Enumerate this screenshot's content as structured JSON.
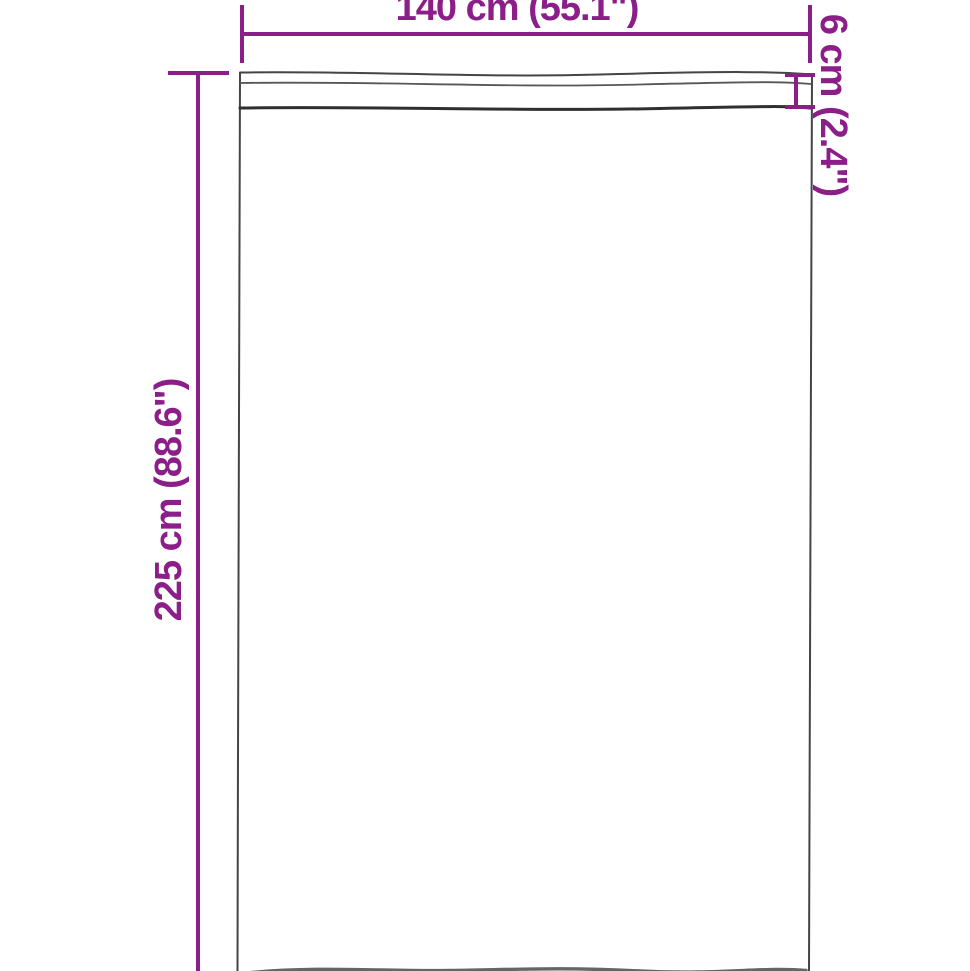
{
  "colors": {
    "accent": "#8b1e88",
    "outline": "#454545"
  },
  "diagram": {
    "labels": {
      "width": "140 cm (55.1\")",
      "height": "225 cm (88.6\")",
      "pocket_depth": "6 cm (2.4\")"
    }
  }
}
